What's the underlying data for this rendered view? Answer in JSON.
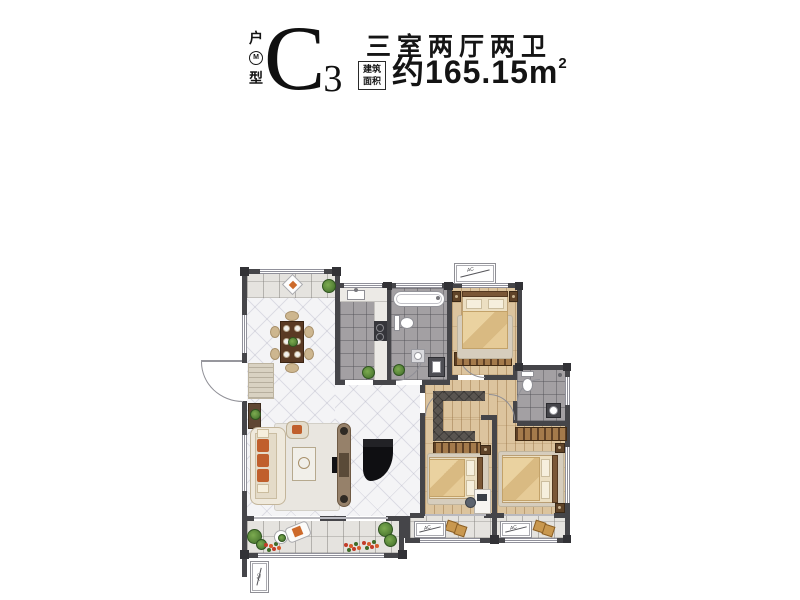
{
  "header": {
    "unit_label_top": "户",
    "unit_label_seal": "M",
    "unit_label_bottom": "型",
    "unit_code": "C",
    "unit_code_subscript": "3",
    "layout_title": "三室两厅两卫",
    "area_box_line1": "建筑",
    "area_box_line2": "面积",
    "area_value_prefix": "约",
    "area_value": "165.15",
    "area_unit": "m",
    "area_unit_superscript": "2"
  },
  "floorplan": {
    "ac_unit_label": "AC",
    "rooms": [
      "north-balcony",
      "dining-area",
      "kitchen",
      "bathroom-1",
      "bedroom-1",
      "hallway",
      "walk-in-closet",
      "bathroom-2",
      "bedroom-2",
      "master-bedroom",
      "living-room",
      "living-balcony",
      "bedroom-balcony"
    ],
    "furniture_icons": [
      "dining-table-icon",
      "sofa-icon",
      "armchair-icon",
      "coffee-table-icon",
      "tv-console-icon",
      "grand-piano-icon",
      "bed-icon",
      "wardrobe-icon",
      "bathtub-icon",
      "toilet-icon",
      "washbasin-icon",
      "washer-icon",
      "stove-icon",
      "kitchen-sink-icon",
      "plant-icon",
      "lounge-chair-icon",
      "side-table-icon",
      "desk-icon",
      "desk-chair-icon",
      "air-conditioner-icon",
      "door-swing-icon",
      "entry-mat-icon",
      "shoe-cabinet-icon",
      "decor-diamond-icon"
    ],
    "colors": {
      "wall": "#454549",
      "marble_floor": "#f4f4f6",
      "tile_floor": "#a3a0a3",
      "wood_floor": "#dcc49e",
      "balcony_floor": "#e5e3df",
      "accent_orange": "#c05f2c",
      "plant_green": "#4e7d33",
      "wood_furniture": "#5f4328",
      "text": "#141414"
    }
  }
}
